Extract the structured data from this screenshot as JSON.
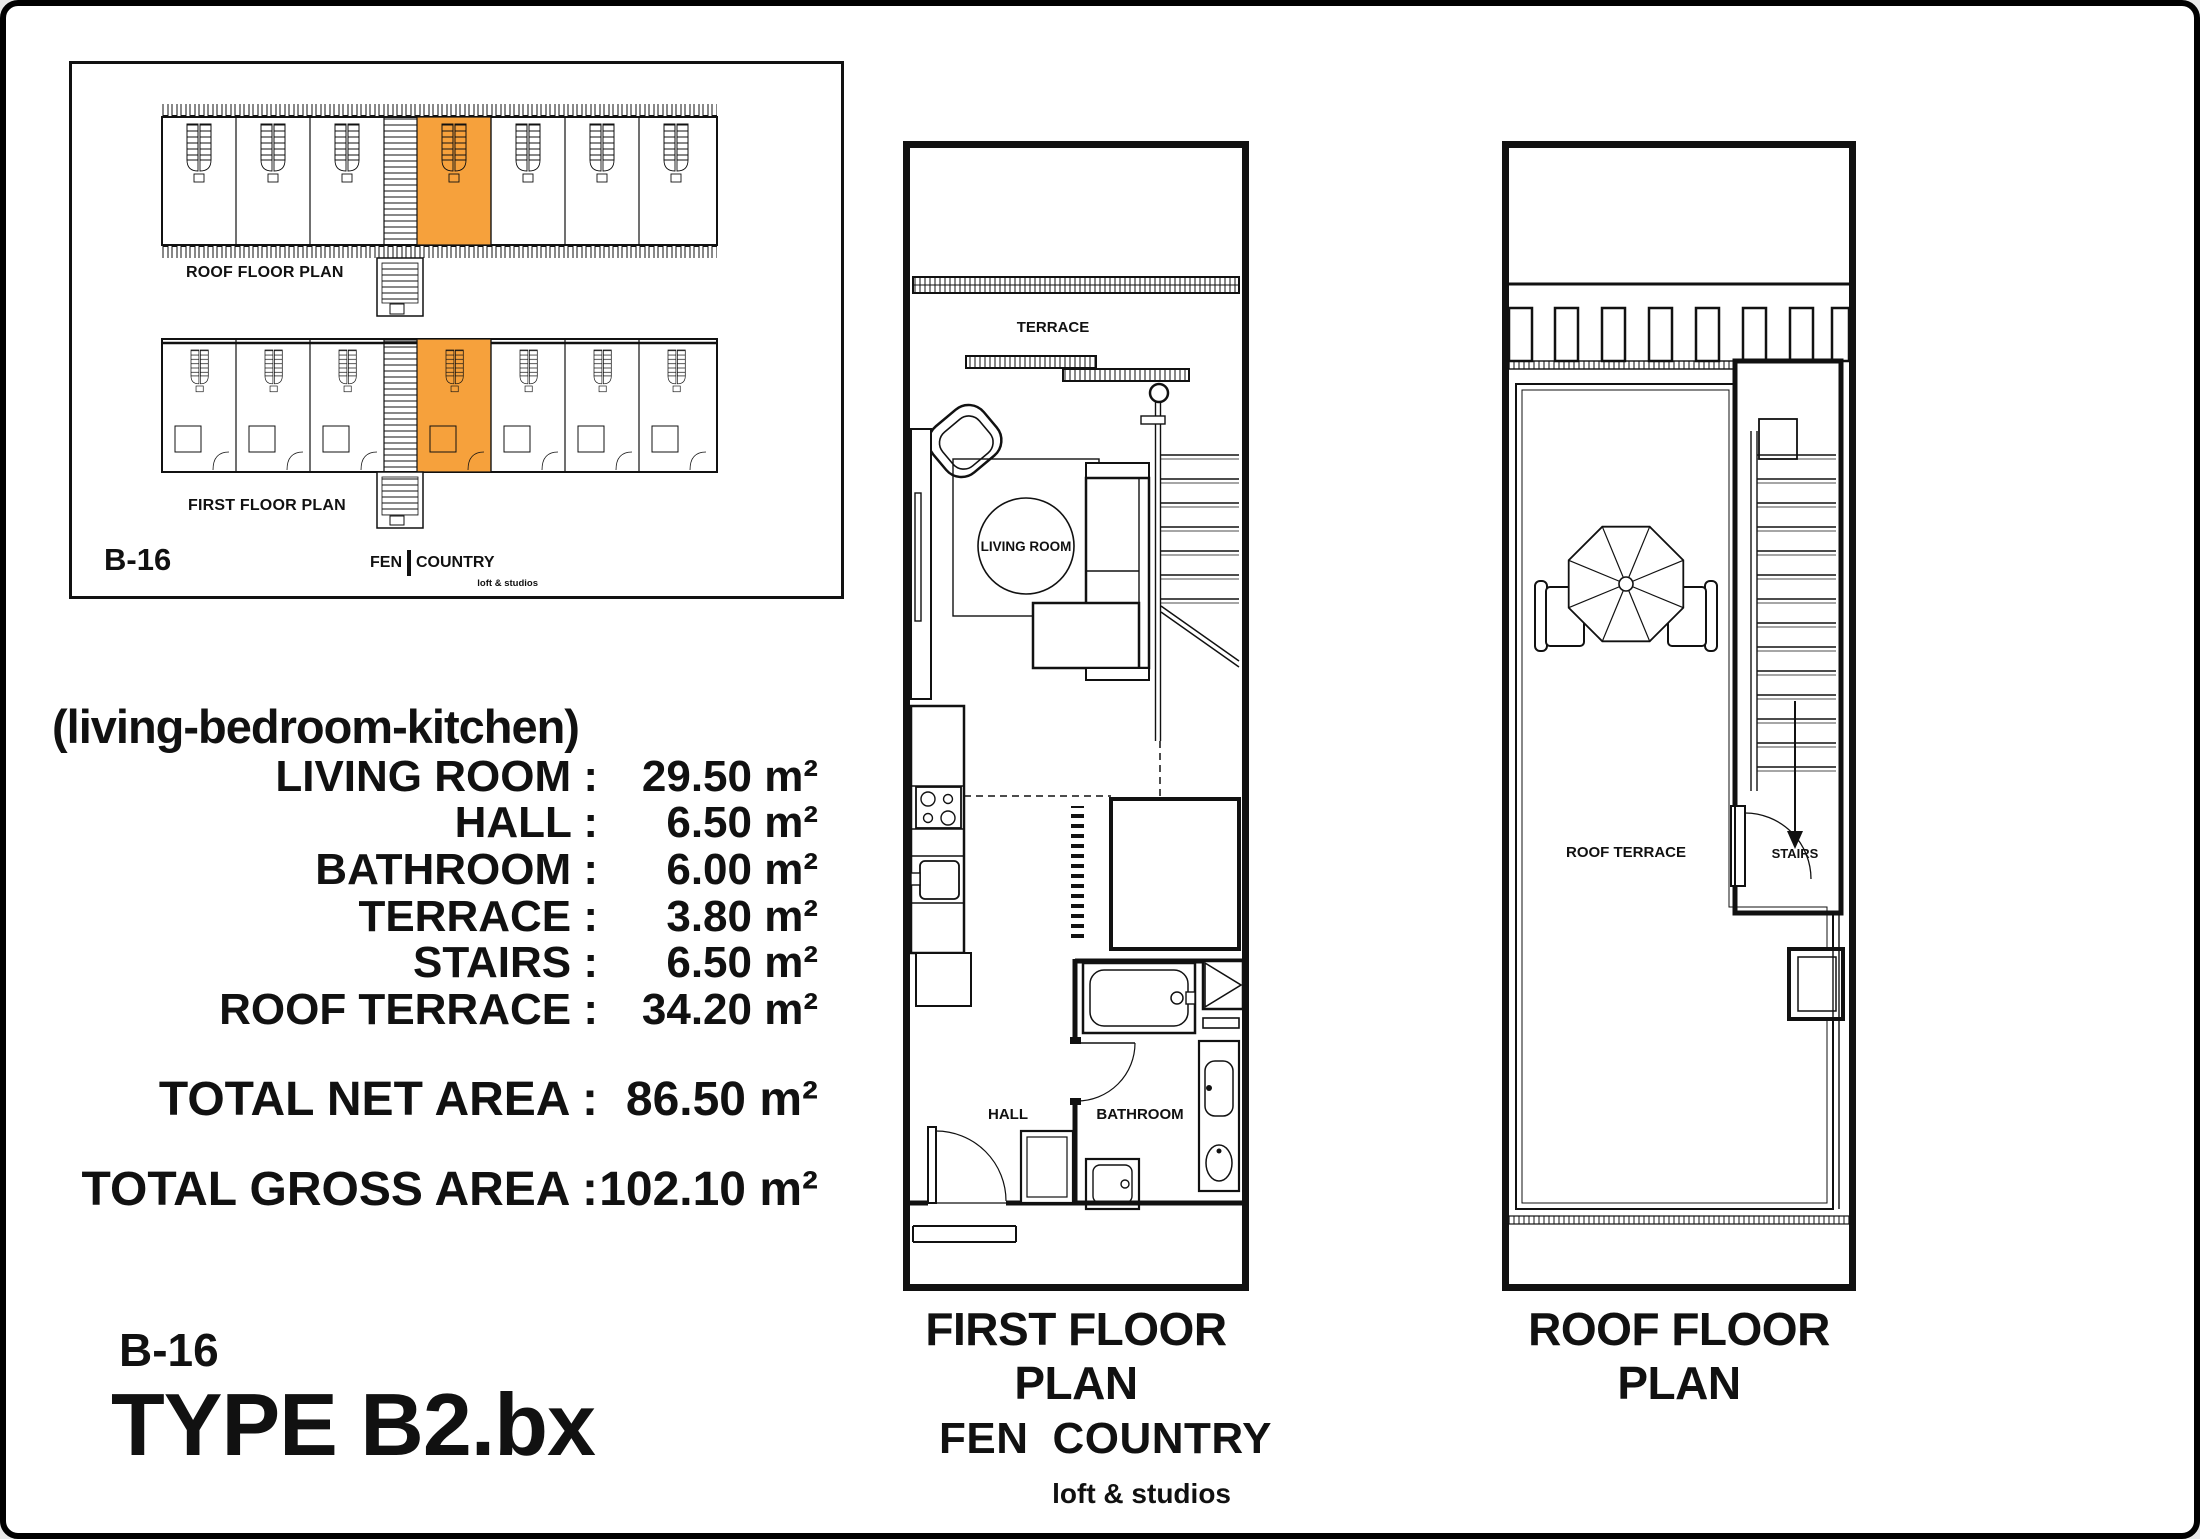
{
  "title_block": {
    "code": "B-16",
    "type": "TYPE B2.bx",
    "subtitle": "(living-bedroom-kitchen)"
  },
  "area_table": {
    "rows": [
      {
        "label": "LIVING ROOM :",
        "value": "29.50 m²"
      },
      {
        "label": "HALL :",
        "value": "6.50 m²"
      },
      {
        "label": "BATHROOM :",
        "value": "6.00 m²"
      },
      {
        "label": "TERRACE :",
        "value": "3.80 m²"
      },
      {
        "label": "STAIRS :",
        "value": "6.50 m²"
      },
      {
        "label": "ROOF TERRACE :",
        "value": "34.20 m²"
      }
    ],
    "total_net_label": "TOTAL NET AREA :",
    "total_net_value": "86.50 m²",
    "total_gross_label": "TOTAL GROSS AREA :",
    "total_gross_value": "102.10 m²"
  },
  "key_plan": {
    "code": "B-16",
    "roof_plan_label": "ROOF FLOOR PLAN",
    "first_plan_label": "FIRST FLOOR PLAN",
    "logo": {
      "fen": "FEN",
      "country": "COUNTRY",
      "tagline": "loft & studios"
    }
  },
  "first_floor": {
    "title": "FIRST FLOOR PLAN",
    "labels": {
      "terrace": "TERRACE",
      "living_room": "LIVING ROOM",
      "hall": "HALL",
      "bathroom": "BATHROOM"
    }
  },
  "roof_floor": {
    "title": "ROOF FLOOR PLAN",
    "labels": {
      "roof_terrace": "ROOF TERRACE",
      "stairs": "STAIRS"
    }
  },
  "footer_logo": {
    "fen": "FEN",
    "country": "COUNTRY",
    "tagline": "loft & studios"
  },
  "colors": {
    "highlight": "#F6A13C",
    "line": "#111111",
    "paper": "#FFFFFF"
  }
}
